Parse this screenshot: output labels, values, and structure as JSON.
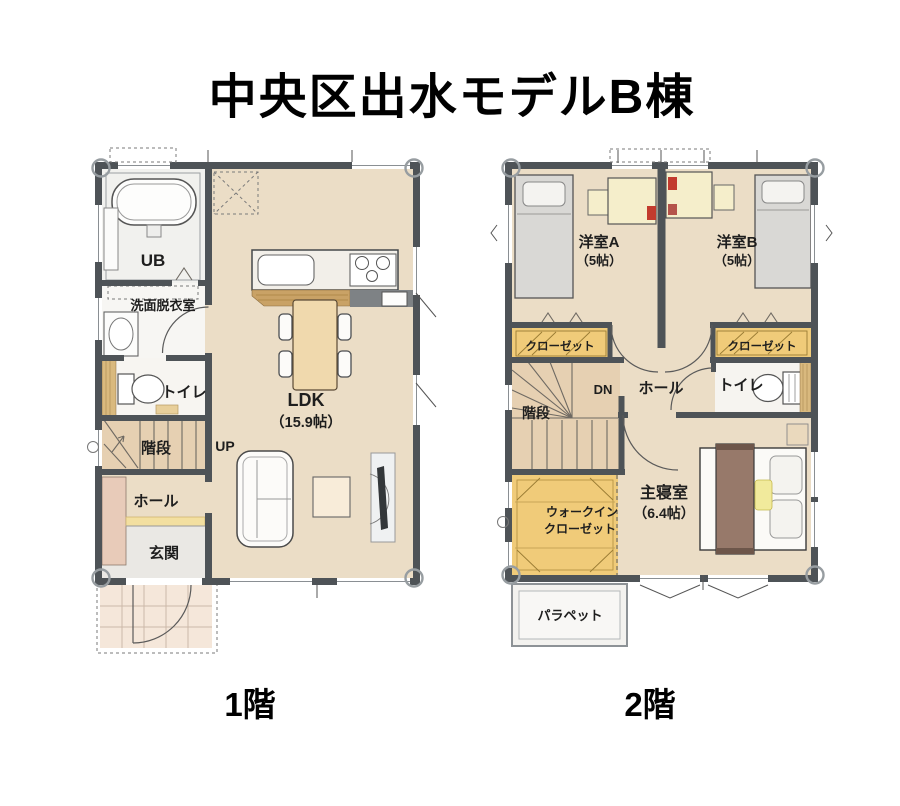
{
  "title": "中央区出水モデルB棟",
  "floors": {
    "f1": {
      "caption": "1階",
      "ub": "UB",
      "senmen": "洗面脱衣室",
      "toilet": "トイレ",
      "stairs": "階段",
      "up": "UP",
      "hall": "ホール",
      "genkan": "玄関",
      "ldk": "LDK",
      "ldk_size": "（15.9帖）"
    },
    "f2": {
      "caption": "2階",
      "room_a": "洋室A",
      "room_a_size": "（5帖）",
      "room_b": "洋室B",
      "room_b_size": "（5帖）",
      "closet_a": "クローゼット",
      "closet_b": "クローゼット",
      "stairs": "階段",
      "dn": "DN",
      "hall": "ホール",
      "toilet": "トイレ",
      "wic_line1": "ウォークイン",
      "wic_line2": "クローゼット",
      "master": "主寝室",
      "master_size": "（6.4帖）",
      "parapet": "パラペット"
    }
  },
  "colors": {
    "wall": "#4e5357",
    "floor": "#ebddc6",
    "floor_light": "#f6f5f2",
    "stairs": "#e6d0b2",
    "closet": "#f0cb79",
    "wood": "#c9a266",
    "table": "#f0d9ad",
    "genkan": "#eae8e4",
    "porch": "#f5e7da",
    "cabinet": "#e8cbb9",
    "bed": "#d9d8d5",
    "blanket": "#97796a",
    "cushion": "#f1ea9c",
    "desk": "#f5eecb",
    "accent_red": "#c23b2e"
  }
}
